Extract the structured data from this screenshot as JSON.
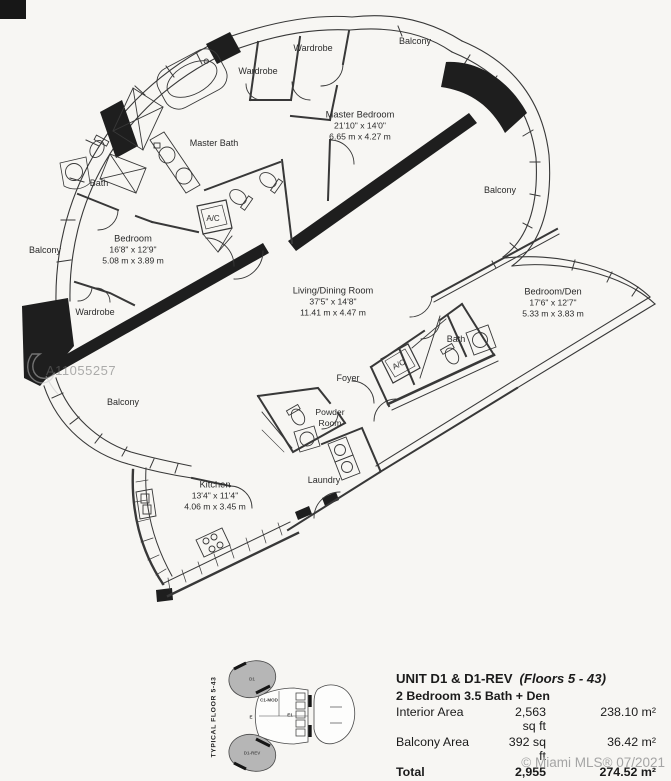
{
  "watermark": {
    "mls_id": "A11055257"
  },
  "plan": {
    "balconies": {
      "top": "Balcony",
      "right": "Balcony",
      "left": "Balcony",
      "bottom": "Balcony"
    },
    "labels": {
      "wardrobe_top": "Wardrobe",
      "wardrobe_mid": "Wardrobe",
      "wardrobe_left": "Wardrobe",
      "master_bath": "Master Bath",
      "bath_left": "Bath",
      "bath_right": "Bath",
      "ac_left": "A/C",
      "ac_right": "A/C",
      "foyer": "Foyer",
      "powder_line1": "Powder",
      "powder_line2": "Room",
      "laundry": "Laundry"
    },
    "rooms": {
      "master_bedroom": {
        "name": "Master Bedroom",
        "ft": "21'10\" x 14'0\"",
        "m": "6.65 m x 4.27 m"
      },
      "bedroom": {
        "name": "Bedroom",
        "ft": "16'8\" x 12'9\"",
        "m": "5.08 m x 3.89 m"
      },
      "living": {
        "name": "Living/Dining Room",
        "ft": "37'5\" x 14'8\"",
        "m": "11.41 m x 4.47 m"
      },
      "bedroom_den": {
        "name": "Bedroom/Den",
        "ft": "17'6\" x 12'7\"",
        "m": "5.33 m x 3.83 m"
      },
      "kitchen": {
        "name": "Kitchen",
        "ft": "13'4\" x 11'4\"",
        "m": "4.06 m x 3.45 m"
      }
    }
  },
  "keyplan": {
    "side_label": "TYPICAL FLOOR 5-43",
    "units": {
      "top_lobe": "D1",
      "bottom_lobe": "D1-REV",
      "center": "C1-MOD",
      "left": "E",
      "right": "E1"
    }
  },
  "info": {
    "title": "UNIT D1 & D1-REV",
    "floors": "(Floors 5 - 43)",
    "subtitle": "2 Bedroom 3.5 Bath + Den",
    "rows": [
      {
        "label": "Interior Area",
        "sqft": "2,563 sq ft",
        "sqm": "238.10 m²"
      },
      {
        "label": "Balcony Area",
        "sqft": "392 sq ft",
        "sqm": "36.42 m²"
      },
      {
        "label": "Total",
        "sqft": "2,955 sq ft",
        "sqm": "274.52 m²"
      }
    ]
  },
  "footer": {
    "credit": "© Miami MLS® 07/2021"
  }
}
